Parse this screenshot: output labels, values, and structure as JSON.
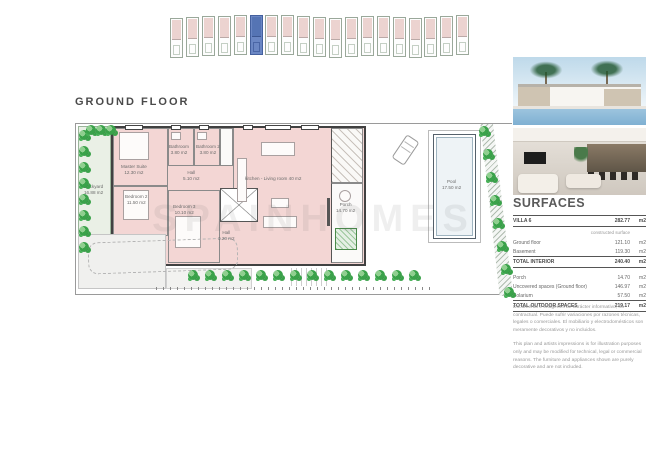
{
  "title": "GROUND FLOOR",
  "site_plan": {
    "unit_count": 19,
    "highlighted_index": 5,
    "highlight_color": "#5b7fbe"
  },
  "floor_plan": {
    "watermark": "SPAINHOMES",
    "rooms": [
      {
        "name": "Backyard",
        "area": "16.88 m2"
      },
      {
        "name": "Master Suite",
        "area": "12.30 m2"
      },
      {
        "name": "Bathroom",
        "area": "3.80 m2"
      },
      {
        "name": "Bathroom 2",
        "area": "3.80 m2"
      },
      {
        "name": "Hall",
        "area": "5.10 m2"
      },
      {
        "name": "Bedroom 2",
        "area": "11.50 m2"
      },
      {
        "name": "Bedroom 3",
        "area": "10.10 m2"
      },
      {
        "name": "Hall",
        "area": "3.20 m2"
      },
      {
        "name": "kitchen - Living room",
        "area": "40 m2"
      },
      {
        "name": "Porch",
        "area": "14.70 m2"
      },
      {
        "name": "Pool",
        "area": "17.50 m2"
      }
    ]
  },
  "surfaces": {
    "heading": "SURFACES",
    "villa": {
      "label": "VILLA 6",
      "value": "282.77",
      "unit": "m2"
    },
    "subheader": "constructed surface",
    "rows_interior": [
      {
        "label": "Ground floor",
        "value": "121.10",
        "unit": "m2"
      },
      {
        "label": "Basement",
        "value": "119.30",
        "unit": "m2"
      }
    ],
    "total_interior": {
      "label": "TOTAL INTERIOR",
      "value": "240.40",
      "unit": "m2"
    },
    "rows_outdoor": [
      {
        "label": "Porch",
        "value": "14.70",
        "unit": "m2"
      },
      {
        "label": "Uncovered spaces (Ground floor)",
        "value": "146.97",
        "unit": "m2"
      },
      {
        "label": "Solarium",
        "value": "57.50",
        "unit": "m2"
      }
    ],
    "total_outdoor": {
      "label": "TOTAL OUTDOOR SPACES",
      "value": "219.17",
      "unit": "m2"
    }
  },
  "disclaimers": {
    "es": "Documento e imágenes de carácter informativo, no contractual. Puede sufrir variaciones por razones técnicas, legales o comerciales. El mobiliario y electrodomésticos son meramente decorativos y no incluidos.",
    "en": "This plan and artists impressions is for illustration purposes only and may be modified for technical, legal or commercial reasons. The furniture and appliances shown are purely decorative and are not included."
  },
  "colors": {
    "room_fill": "#f3d6d4",
    "wall": "#414141",
    "greenery": "#3aa24a",
    "pool_fill": "#eef3f6"
  }
}
